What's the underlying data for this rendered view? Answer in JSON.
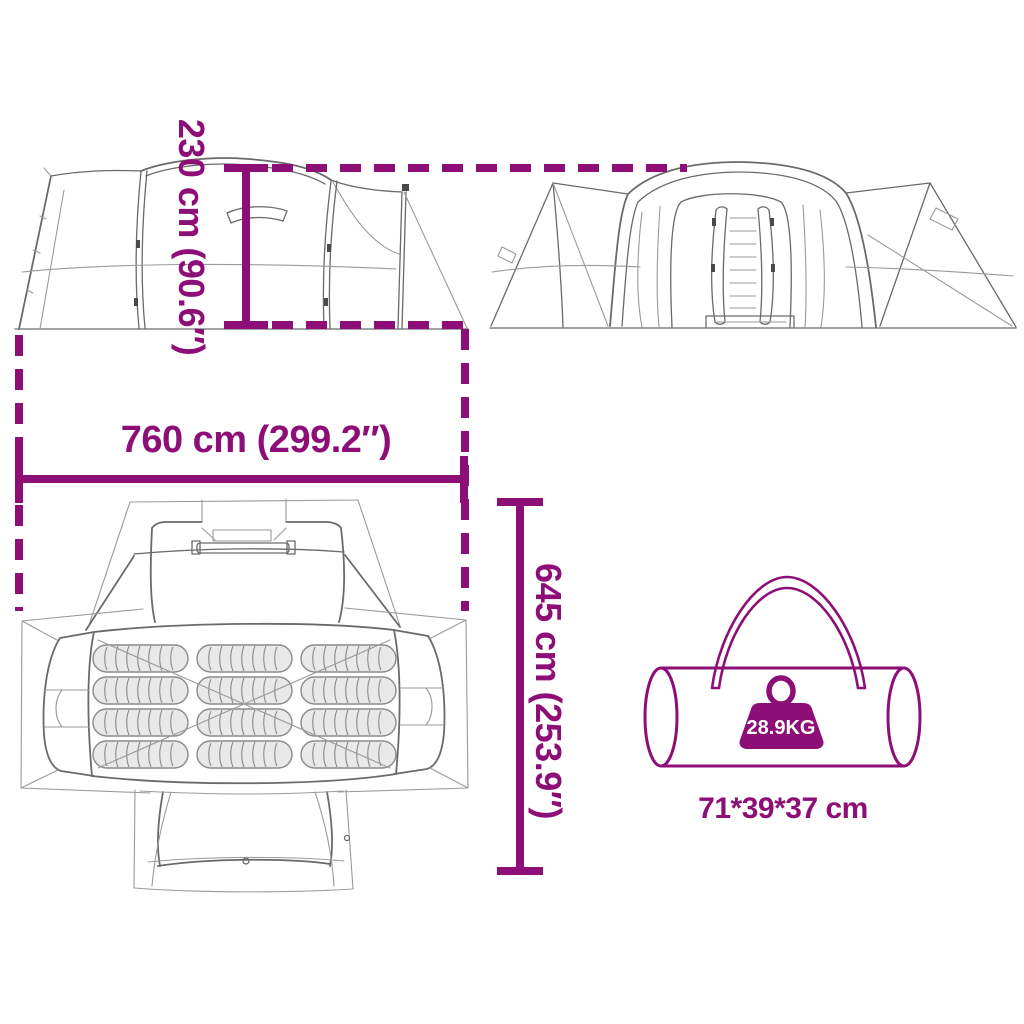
{
  "colors": {
    "accent": "#8E0E77",
    "line": "#6a6a6a",
    "thin": "#9a9a9a",
    "clip": "#4a4a4a",
    "mat-fill": "#e9e9e9",
    "mat-line": "#8a8a8a",
    "weight-label": "#ffffff",
    "background": "#ffffff"
  },
  "dimensions": {
    "height": {
      "label": "230 cm (90.6″)",
      "value_cm": 230,
      "value_in": 90.6
    },
    "length": {
      "label": "760 cm (299.2″)",
      "value_cm": 760,
      "value_in": 299.2
    },
    "depth": {
      "label": "645 cm (253.9″)",
      "value_cm": 645,
      "value_in": 253.9
    }
  },
  "package": {
    "weight_label": "28.9KG",
    "size_label": "71*39*37 cm"
  },
  "top_view": {
    "mat_rows": 4,
    "mat_columns": 3
  }
}
